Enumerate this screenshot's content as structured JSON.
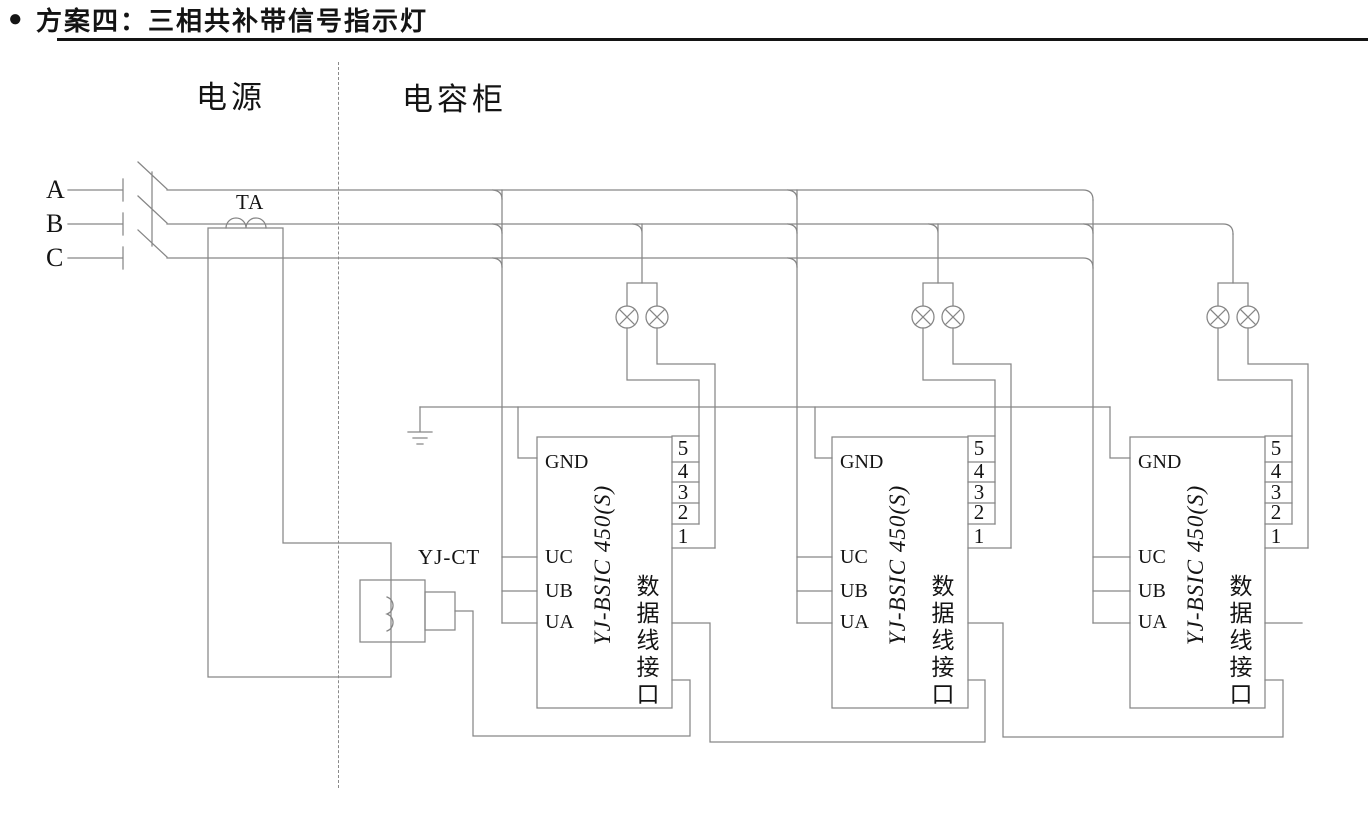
{
  "title": {
    "bullet": "●",
    "text": "方案四：三相共补带信号指示灯"
  },
  "sections": {
    "power_label": "电源",
    "cabinet_label": "电容柜"
  },
  "phase_labels": [
    "A",
    "B",
    "C"
  ],
  "ta_label": "TA",
  "ct_label": "YJ-CT",
  "modules": [
    {
      "model": "YJ-BSIC 450(S)",
      "pins_left": {
        "gnd": "GND",
        "uc": "UC",
        "ub": "UB",
        "ua": "UA"
      },
      "pins_right": [
        "5",
        "4",
        "3",
        "2",
        "1"
      ],
      "port": "数据线接口"
    },
    {
      "model": "YJ-BSIC 450(S)",
      "pins_left": {
        "gnd": "GND",
        "uc": "UC",
        "ub": "UB",
        "ua": "UA"
      },
      "pins_right": [
        "5",
        "4",
        "3",
        "2",
        "1"
      ],
      "port": "数据线接口"
    },
    {
      "model": "YJ-BSIC 450(S)",
      "pins_left": {
        "gnd": "GND",
        "uc": "UC",
        "ub": "UB",
        "ua": "UA"
      },
      "pins_right": [
        "5",
        "4",
        "3",
        "2",
        "1"
      ],
      "port": "数据线接口"
    }
  ],
  "colors": {
    "line": "#868686",
    "text": "#141414"
  }
}
